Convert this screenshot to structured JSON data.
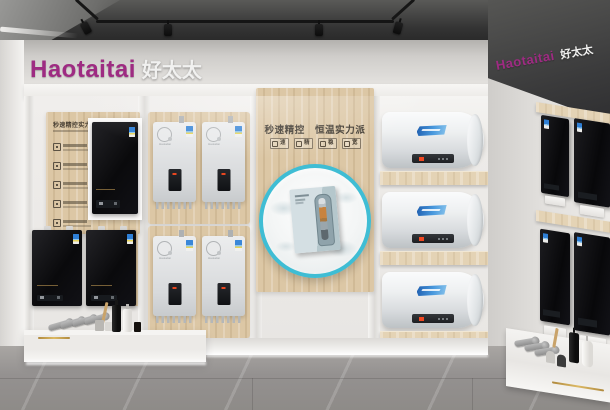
{
  "brand": {
    "latin": "Haotaitai",
    "cjk": "好太太"
  },
  "logo_right": {
    "latin": "Haotaitai",
    "cjk": "好太太"
  },
  "colors": {
    "brand_magenta": "#9e2b82",
    "accent_cyan": "#3fbdd4",
    "wood": "#dcc7a5",
    "led_red": "#f04822"
  },
  "wall_left_panel": {
    "title": "秒速精控实力派"
  },
  "wall_center_panel": {
    "headline": "秒速精控　恒温实力派",
    "badges": [
      {
        "label": "速"
      },
      {
        "label": "精"
      },
      {
        "label": "稳"
      },
      {
        "label": "宽"
      }
    ]
  }
}
